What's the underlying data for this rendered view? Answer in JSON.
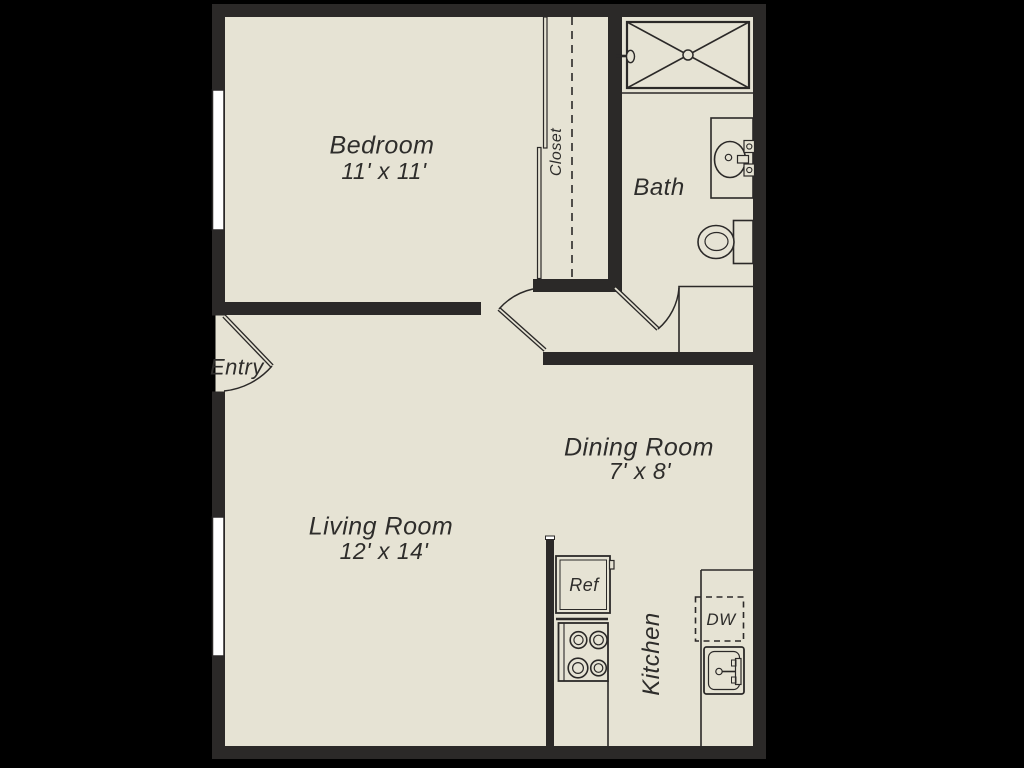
{
  "title": "One-bedroom apartment floor plan",
  "rooms": {
    "bedroom": {
      "label": "Bedroom",
      "dims": "11' x 11'"
    },
    "living_room": {
      "label": "Living Room",
      "dims": "12' x 14'"
    },
    "dining_room": {
      "label": "Dining Room",
      "dims": "7' x 8'"
    },
    "bath": {
      "label": "Bath"
    },
    "kitchen": {
      "label": "Kitchen"
    },
    "closet": {
      "label": "Closet"
    },
    "entry": {
      "label": "Entry"
    }
  },
  "appliances": {
    "refrigerator": "Ref",
    "dishwasher": "DW"
  },
  "fixtures": [
    "shower-icon",
    "vanity-sink-icon",
    "toilet-icon",
    "refrigerator-icon",
    "stove-icon",
    "dishwasher-icon",
    "kitchen-sink-icon",
    "entry-door-icon",
    "bedroom-door-icon",
    "bath-door-icon",
    "window-icon",
    "closet-rod-icon",
    "dining-counter",
    "kitchen-counter"
  ],
  "colors": {
    "background": "#000000",
    "floor": "#e6e3d4",
    "wall": "#2b2928",
    "line": "#2b2928",
    "window": "#ffffff",
    "text": "#2e2d2b"
  }
}
